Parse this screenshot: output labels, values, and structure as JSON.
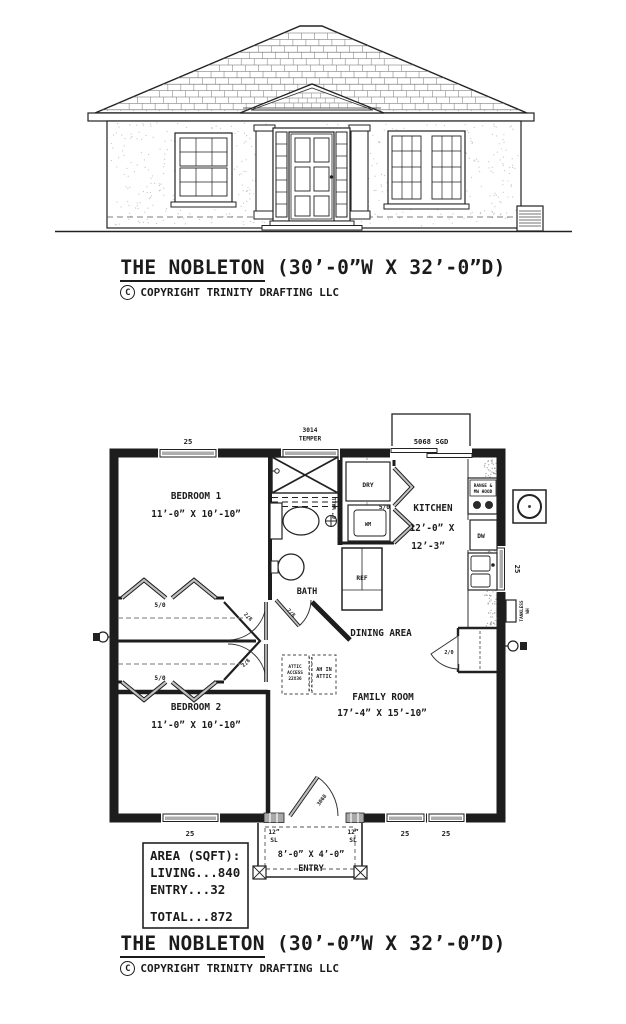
{
  "titles": {
    "main": "THE NOBLETON",
    "dims": " (30’-0”W X 32’-0”D)",
    "copyright_symbol": "C",
    "copyright": "COPYRIGHT TRINITY DRAFTING LLC"
  },
  "plan": {
    "rooms": {
      "bedroom1": {
        "name": "BEDROOM 1",
        "dims": "11’-0” X 10’-10”"
      },
      "bedroom2": {
        "name": "BEDROOM 2",
        "dims": "11’-0” X 10’-10”"
      },
      "bath": {
        "name": "BATH"
      },
      "kitchen": {
        "name": "KITCHEN",
        "dims1": "12’-0” X",
        "dims2": "12’-3”"
      },
      "dining": {
        "name": "DINING AREA"
      },
      "family": {
        "name": "FAMILY ROOM",
        "dims": "17’-4” X 15’-10”"
      },
      "entry": {
        "name": "ENTRY",
        "dims": "8’-0” X 4’-0”"
      }
    },
    "openings": {
      "window_25": "25",
      "temper1": "3014",
      "temper2": "TEMPER",
      "sgd": "5068 SGD",
      "front_door": "3068",
      "sidelight1": "12”",
      "sidelight2": "SL",
      "bifold": "5/0",
      "hall_door": "2/8",
      "pantry_door": "2/0"
    },
    "fixtures": {
      "dryer": "DRY",
      "washer": "WM",
      "fridge": "REF",
      "dishwasher": "DW",
      "range1": "RANGE &",
      "range2": "MW HOOD",
      "tankless1": "TANKLESS",
      "tankless2": "WH"
    },
    "notes": {
      "wall": "6” WALL",
      "attic1": "ATTIC",
      "attic2": "ACCESS",
      "attic3": "22X36",
      "ah1": "AH IN",
      "ah2": "ATTIC"
    },
    "area_table": {
      "header": "AREA (SQFT):",
      "living": "LIVING...840",
      "entry": "ENTRY...32",
      "total": "TOTAL...872"
    }
  }
}
